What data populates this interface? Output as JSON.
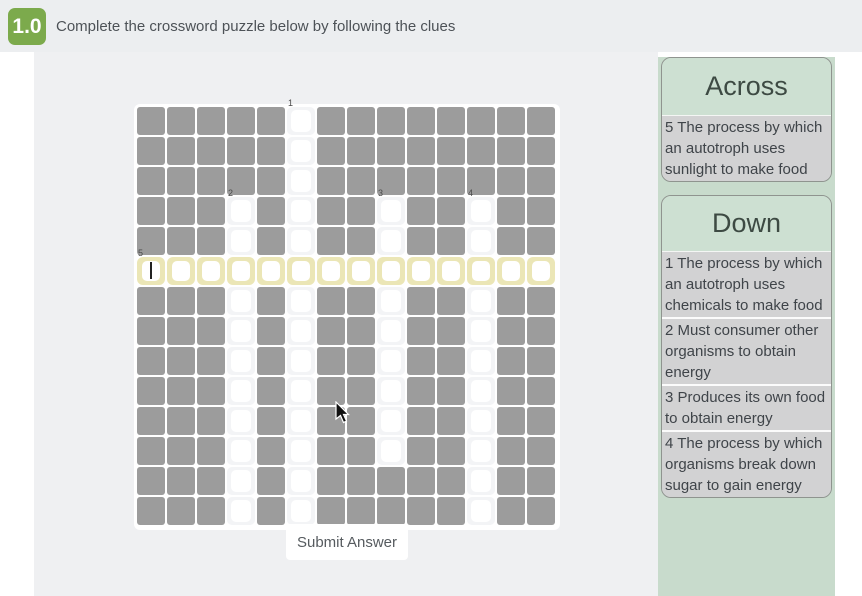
{
  "header": {
    "badge": "1.0",
    "title": "Complete the crossword puzzle below by following the clues"
  },
  "grid": {
    "rows": [
      "#####.########",
      "#####.########",
      "#####.########",
      "###.#.##.##.##",
      "###.#.##.##.##",
      "HHHHHHHHHHHHHH",
      "###.#.##.##.##",
      "###.#.##.##.##",
      "###.#.##.##.##",
      "###.#.##.##.##",
      "###.#.##.##.##",
      "###.#.##.##.##",
      "###.#.#####.##",
      "###.#.#####.##"
    ],
    "numbers": [
      {
        "row": 0,
        "col": 5,
        "label": "1"
      },
      {
        "row": 3,
        "col": 3,
        "label": "2"
      },
      {
        "row": 3,
        "col": 8,
        "label": "3"
      },
      {
        "row": 3,
        "col": 11,
        "label": "4"
      },
      {
        "row": 5,
        "col": 0,
        "label": "5"
      }
    ],
    "cursor_cell": {
      "row": 5,
      "col": 0
    }
  },
  "submit_label": "Submit Answer",
  "across": {
    "title": "Across",
    "clues": [
      "5 The process by which an autotroph uses sunlight to make food"
    ]
  },
  "down": {
    "title": "Down",
    "clues": [
      "1 The process by which an autotroph uses chemicals to make food",
      "2 Must consumer other organisms to obtain energy",
      "3 Produces its own food to obtain energy",
      "4 The process by which organisms break down sugar to gain energy"
    ]
  },
  "colors": {
    "badge_green": "#7caa4c",
    "panel_green": "#c8dbcc",
    "card_header_green": "#cde0d2",
    "clue_gray": "#d2d2d3",
    "block_gray": "#9c9c9c",
    "highlight_yellow": "#ebe6b6",
    "header_gray": "#eceef0",
    "main_gray": "#eff0f2"
  }
}
